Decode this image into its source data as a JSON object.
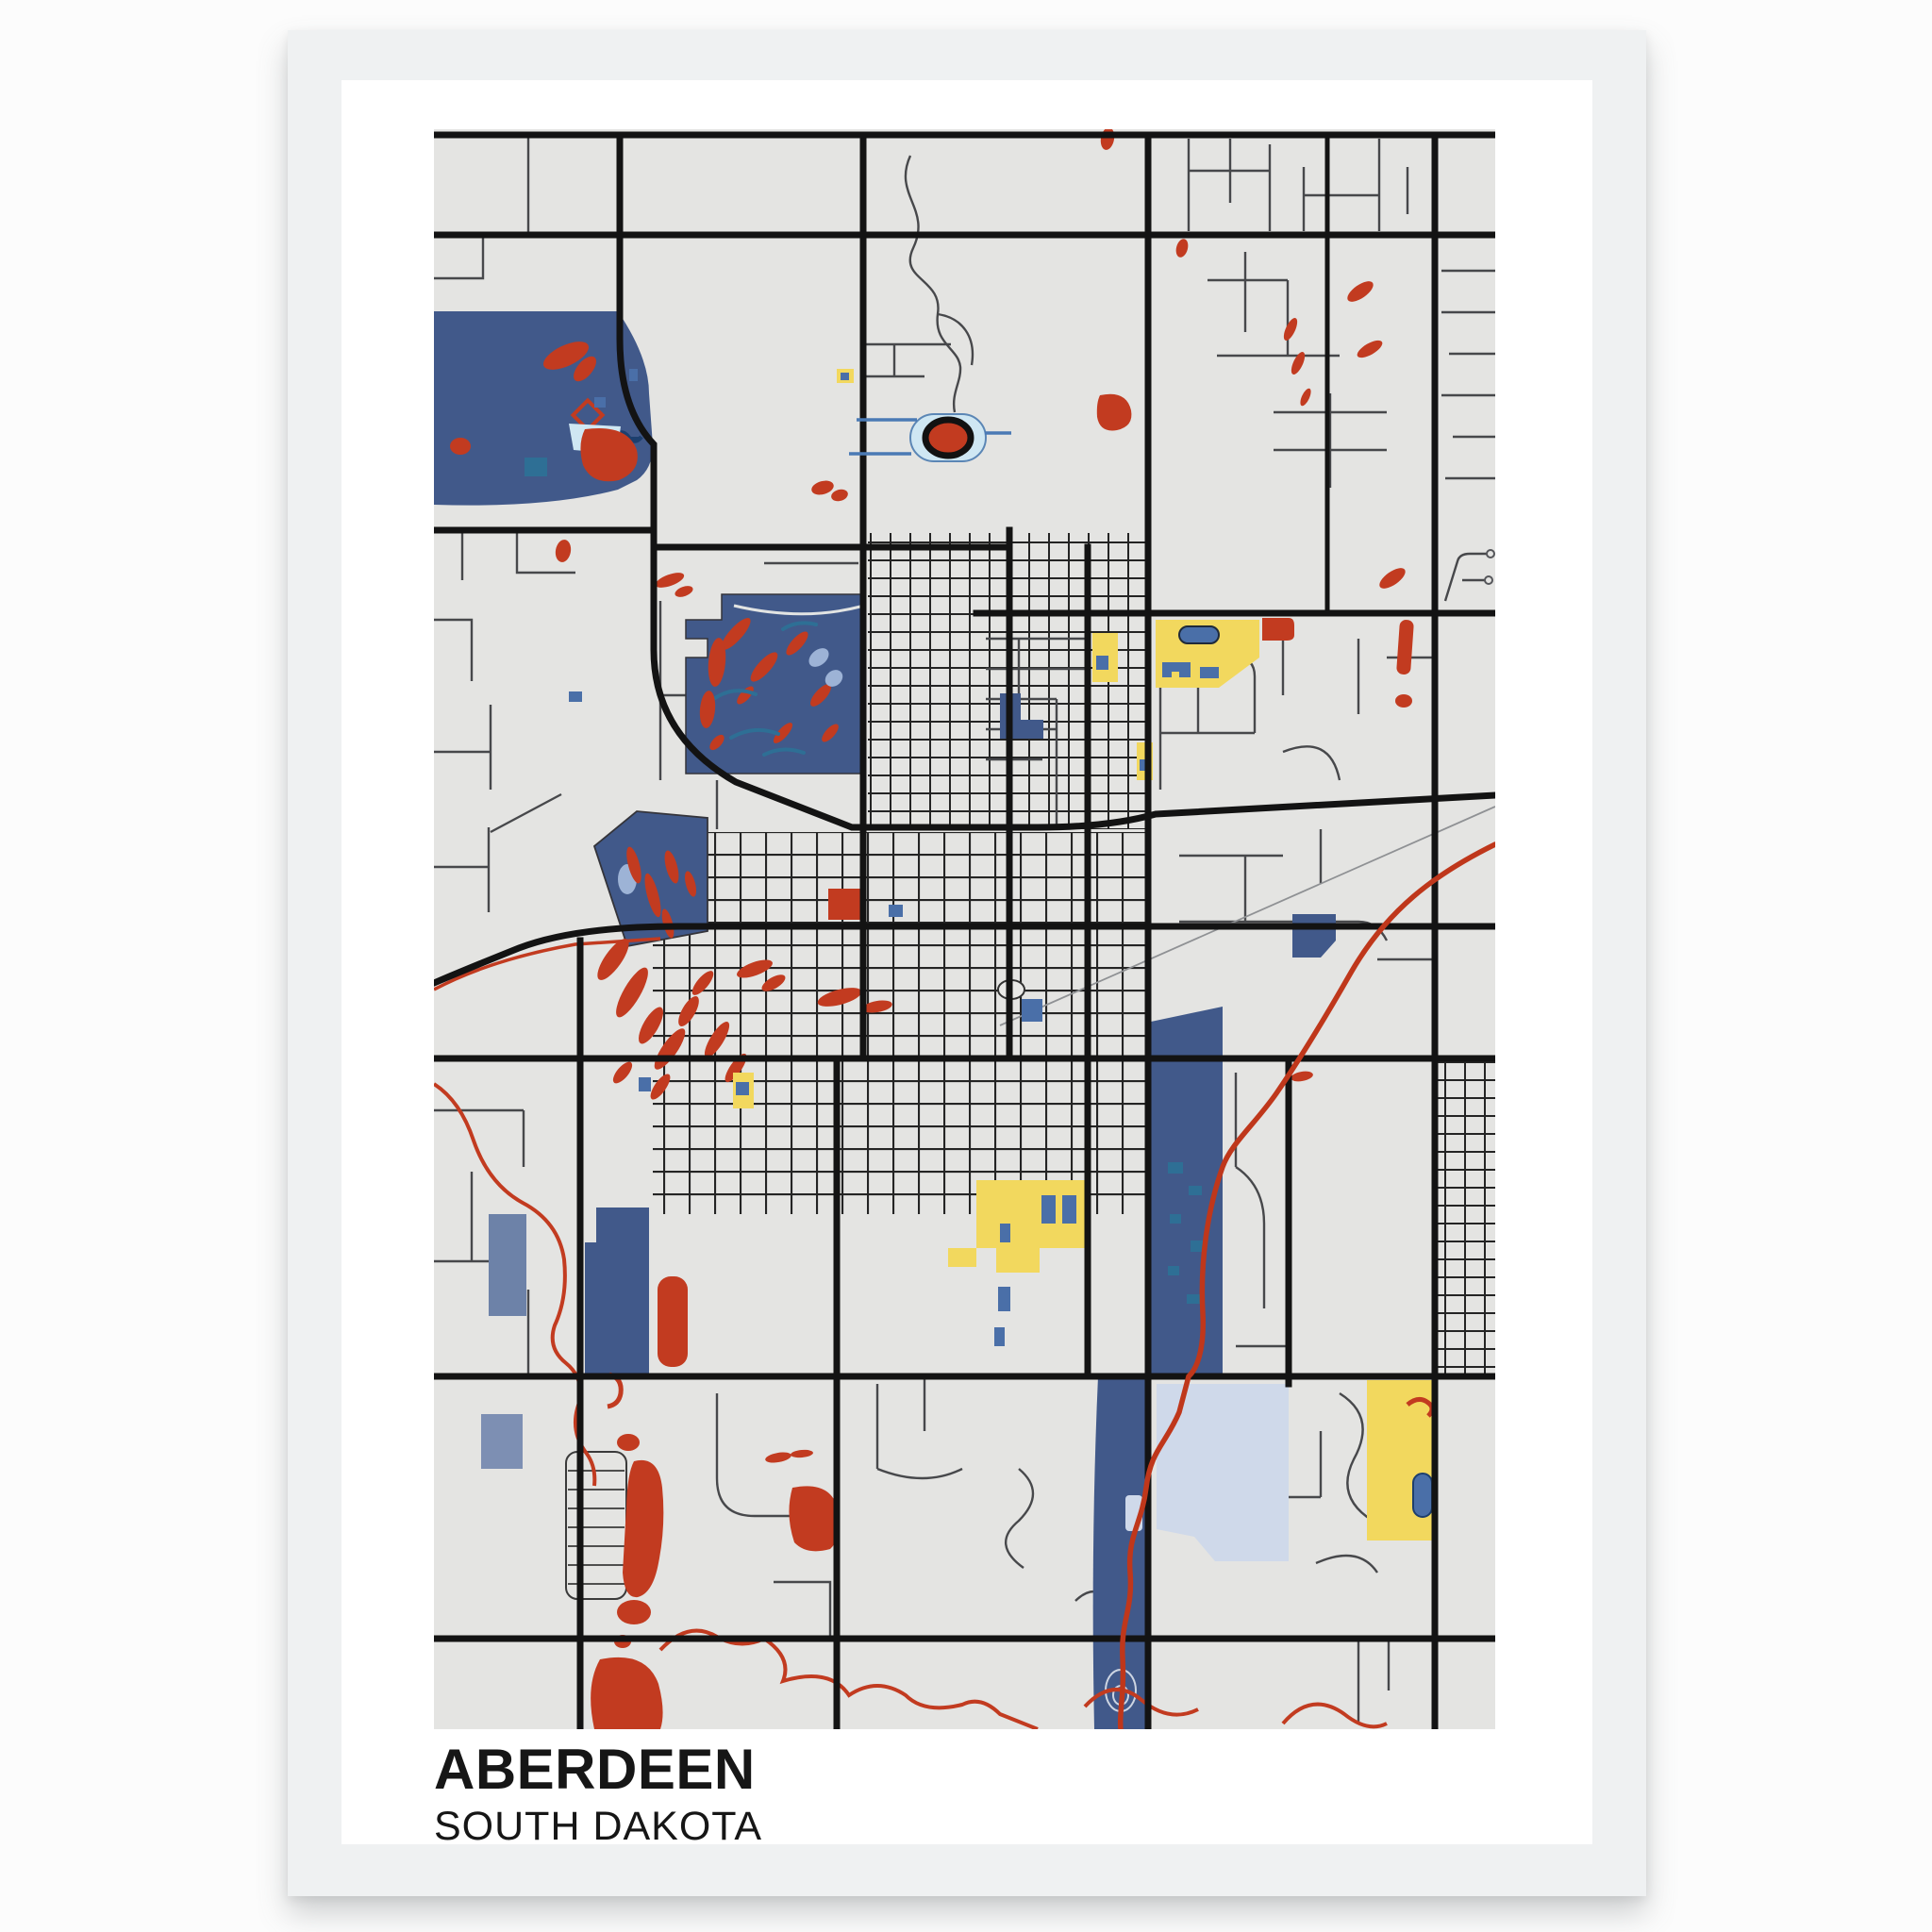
{
  "poster": {
    "title": "ABERDEEN",
    "subtitle": "SOUTH DAKOTA",
    "artwork": "stylized mondrian-style street map print in a white frame",
    "colors": {
      "page": "#fcfcfc",
      "frame": "#eff1f2",
      "mat": "#ffffff",
      "mapbg": "#e4e4e2",
      "road": "#131313",
      "minor": "#47484b",
      "water": "#41598a",
      "red": "#c23b20",
      "yellow": "#f2d85e",
      "pale": "#cfd9ea",
      "paleblue": "#cfe7f3",
      "teal": "#2e6f95",
      "peri": "#9db3d6",
      "creek": "#bf371b",
      "title": "#161616"
    },
    "map_features": [
      "northwest-lake-area",
      "large-park-with-red-streaks",
      "small-park-pentagon",
      "stadium-oval-track",
      "dense-downtown-street-grid",
      "blue-creek-corridor",
      "red-creek-line",
      "winding-red-river-line",
      "yellow-campus-zones",
      "pale-blue-course-area",
      "industrial-blue-blocks",
      "scattered-red-tree-blobs",
      "trailer-court-ladder-streets"
    ]
  }
}
